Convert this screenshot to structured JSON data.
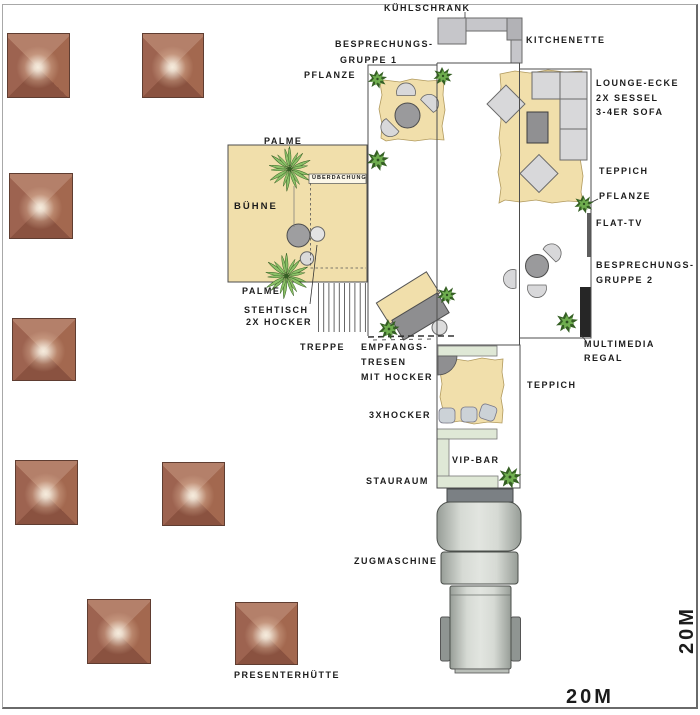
{
  "labels": {
    "kuehlschrank": "KÜHLSCHRANK",
    "kitchenette": "KITCHENETTE",
    "bespr1_l1": "BESPRECHUNGS-",
    "bespr1_l2": "GRUPPE 1",
    "pflanze_top_left": "PFLANZE",
    "lounge_l1": "LOUNGE-ECKE",
    "lounge_l2": "2X SESSEL",
    "lounge_l3": "3-4ER SOFA",
    "teppich_lounge": "TEPPICH",
    "pflanze_right": "PFLANZE",
    "flat_tv": "FLAT-TV",
    "bespr2_l1": "BESPRECHUNGS-",
    "bespr2_l2": "GRUPPE 2",
    "multimedia_l1": "MULTIMEDIA",
    "multimedia_l2": "REGAL",
    "palme_top": "PALME",
    "ueberdachung": "ÜBERDACHUNG",
    "buehne": "BÜHNE",
    "palme_bottom": "PALME",
    "stehtisch_l1": "STEHTISCH",
    "stehtisch_l2": "2X HOCKER",
    "treppe": "TREPPE",
    "empfang_l1": "EMPFANGS-",
    "empfang_l2": "TRESEN",
    "empfang_l3": "MIT HOCKER",
    "teppich_vip": "TEPPICH",
    "hocker3": "3XHOCKER",
    "vip_bar": "VIP-BAR",
    "stauraum": "STAURAUM",
    "zugmaschine": "ZUGMASCHINE",
    "presenterhuette": "PRESENTERHÜTTE",
    "scale_horizontal": "20M",
    "scale_vertical": "20M"
  },
  "counts": {
    "presenter_huts": 8,
    "plants": 8,
    "palms": 2
  },
  "icons": {
    "palm-icon": "radial frond starburst (palm, top view)",
    "plant-icon": "spiky leaf cluster (plant, top view)"
  },
  "colors": {
    "ink": "#1c1c1c",
    "wall": "#4d4d4d",
    "tan": "#f1dfab",
    "tanEdge": "#b19a5e",
    "furnLight": "#d8d8da",
    "furnDark": "#909092",
    "kitchen": "#c6c6ca",
    "kitchenDark": "#b2b2b6",
    "barGreen": "#dfe8d6",
    "stoolBlue": "#ccd2d7",
    "tv": "#5e5e5e",
    "regal": "#262626",
    "plantG": "#6fae4f",
    "plantD": "#355f24",
    "palmG": "#8cc168",
    "wheel": "#8f9592",
    "tractorLine": "#4b4f4b",
    "hutDark": "#8a5240",
    "hutMid": "#a3684f",
    "hutLight": "#f6ecdd"
  }
}
